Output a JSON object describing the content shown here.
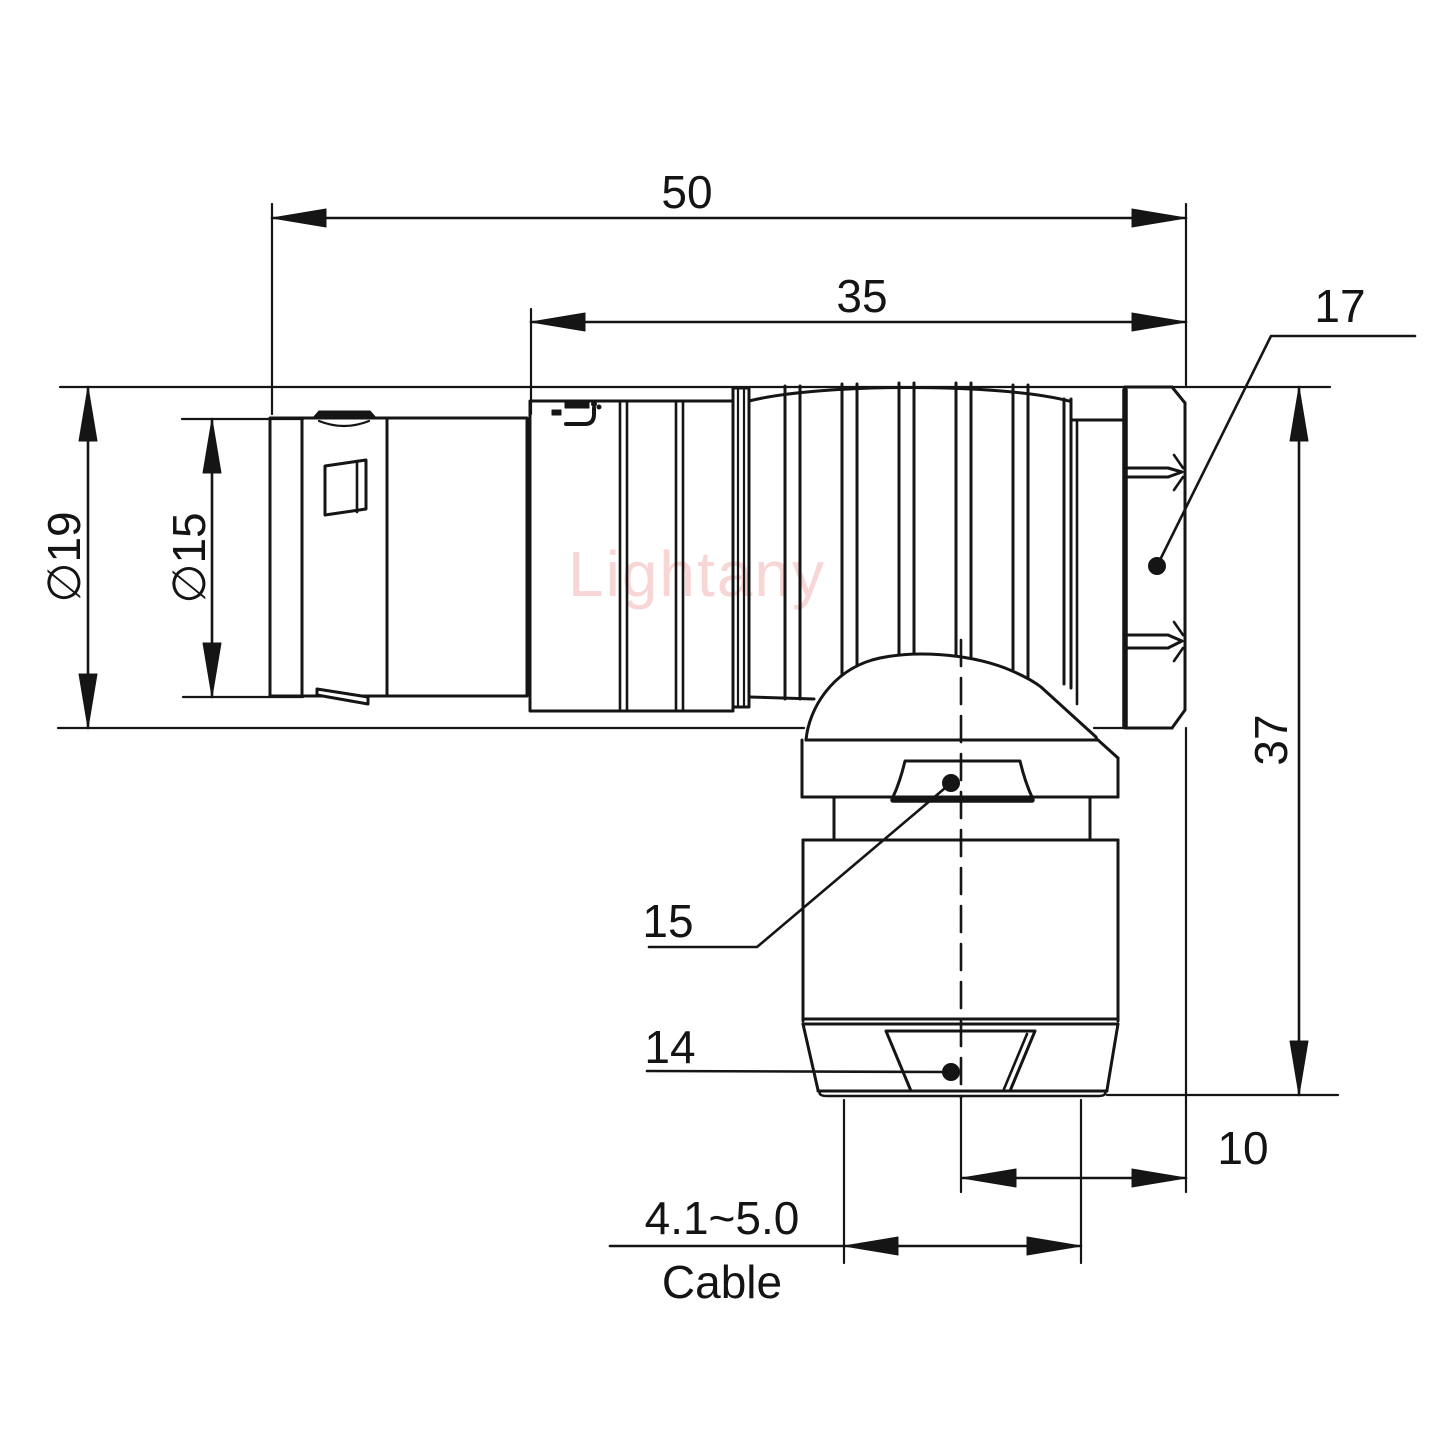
{
  "watermark": {
    "text": "Lightany"
  },
  "brand_mark": {
    "icon": "lightany-logo"
  },
  "dimensions": {
    "overall_length": "50",
    "shell_length": "35",
    "nut_across_flats": "17",
    "outer_diameter": "∅19",
    "front_shell_diameter": "∅15",
    "overall_height": "37",
    "collar_nut_size": "15",
    "collet_nut_size": "14",
    "axis_to_rear_face": "10",
    "cable_clamp_range": "4.1~5.0",
    "cable_caption": "Cable"
  }
}
